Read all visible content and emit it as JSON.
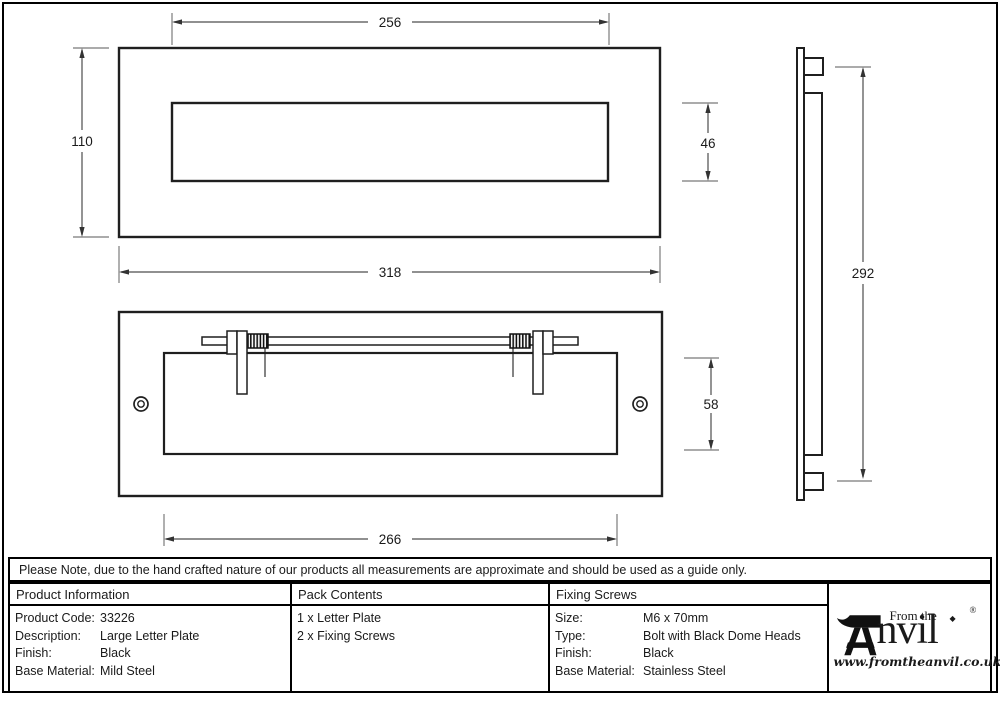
{
  "drawing": {
    "front_view": {
      "aperture_width": "256",
      "plate_height": "110",
      "plate_width": "318",
      "aperture_height": "46"
    },
    "back_view": {
      "flap_height": "58",
      "flap_width": "266"
    },
    "side_view": {
      "overall_height": "292"
    }
  },
  "note": "Please Note, due to the hand crafted nature of our products all measurements are approximate and should be used as a guide only.",
  "table": {
    "product_info": {
      "header": "Product Information",
      "rows": [
        {
          "label": "Product Code:",
          "value": "33226"
        },
        {
          "label": "Description:",
          "value": "Large Letter Plate"
        },
        {
          "label": "Finish:",
          "value": "Black"
        },
        {
          "label": "Base Material:",
          "value": "Mild Steel"
        }
      ]
    },
    "pack_contents": {
      "header": "Pack Contents",
      "items": [
        "1 x Letter Plate",
        "2 x Fixing Screws"
      ]
    },
    "fixing_screws": {
      "header": "Fixing Screws",
      "rows": [
        {
          "label": "Size:",
          "value": "M6 x 70mm"
        },
        {
          "label": "Type:",
          "value": "Bolt with Black Dome Heads"
        },
        {
          "label": "Finish:",
          "value": "Black"
        },
        {
          "label": "Base Material:",
          "value": "Stainless Steel"
        }
      ]
    }
  },
  "logo": {
    "prefix": "From the",
    "name_suffix": "nvil",
    "registered": "®",
    "website": "www.fromtheanvil.co.uk"
  },
  "colors": {
    "line": "#1f1f1f",
    "dimension": "#4d4d4d",
    "extension": "#8f8f8f"
  }
}
